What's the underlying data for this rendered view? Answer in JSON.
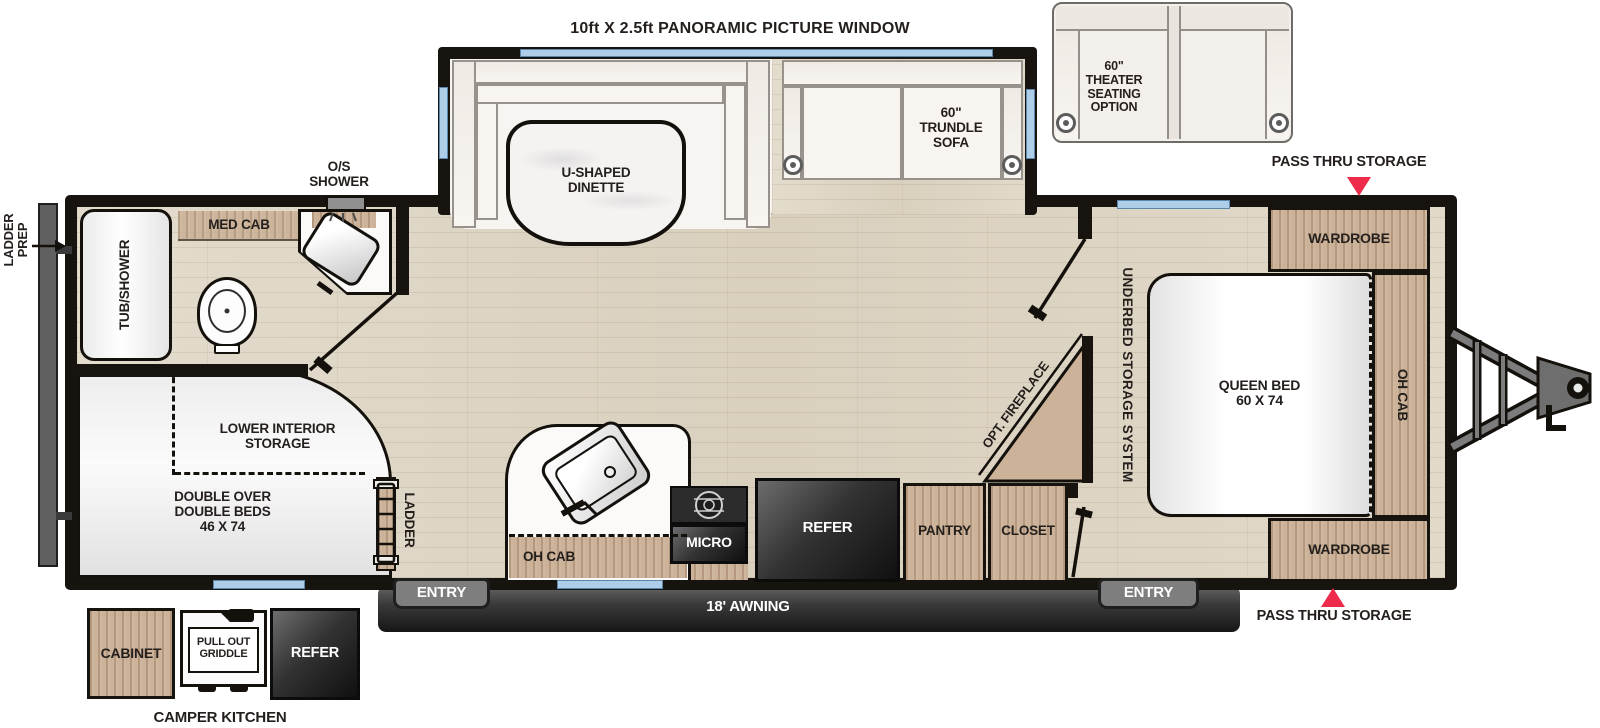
{
  "title": "Travel trailer floor plan",
  "labels": {
    "window_note": "10ft X 2.5ft PANORAMIC PICTURE WINDOW",
    "dinette": "U-SHAPED\nDINETTE",
    "trundle_sofa": "60\"\nTRUNDLE\nSOFA",
    "theater": "60\"\nTHEATER\nSEATING\nOPTION",
    "pass_thru_top": "PASS THRU STORAGE",
    "pass_thru_bottom": "PASS THRU STORAGE",
    "wardrobe_top": "WARDROBE",
    "wardrobe_bottom": "WARDROBE",
    "queen_bed": "QUEEN BED\n60 X 74",
    "oh_cab_bed": "OH CAB",
    "underbed": "UNDERBED STORAGE SYSTEM",
    "med_cab": "MED CAB",
    "os_shower": "O/S\nSHOWER",
    "tub_shower": "TUB/SHOWER",
    "ladder_prep": "LADDER\nPREP",
    "lower_storage": "LOWER INTERIOR\nSTORAGE",
    "double_beds": "DOUBLE OVER\nDOUBLE BEDS\n46 X 74",
    "ladder": "LADDER",
    "oh_cab_kitchen": "OH CAB",
    "micro": "MICRO",
    "refer": "REFER",
    "pantry": "PANTRY",
    "closet": "CLOSET",
    "opt_fireplace": "OPT. FIREPLACE",
    "tv_ent": "TV ENT.CTR.",
    "entry_left": "ENTRY",
    "entry_right": "ENTRY",
    "awning": "18' AWNING",
    "camper_kitchen": "CAMPER KITCHEN",
    "cabinet": "CABINET",
    "griddle": "PULL OUT\nGRIDDLE",
    "camper_refer": "REFER"
  },
  "colors": {
    "accent_red": "#ee2b4a",
    "window_blue": "#aecde8",
    "wall_black": "#17130f",
    "cabinet_wood": "#cbb298",
    "floor_wood": "#ded6c6",
    "appliance_dark": "#1e1e1e",
    "awning_gray": "#4a4a4a"
  }
}
